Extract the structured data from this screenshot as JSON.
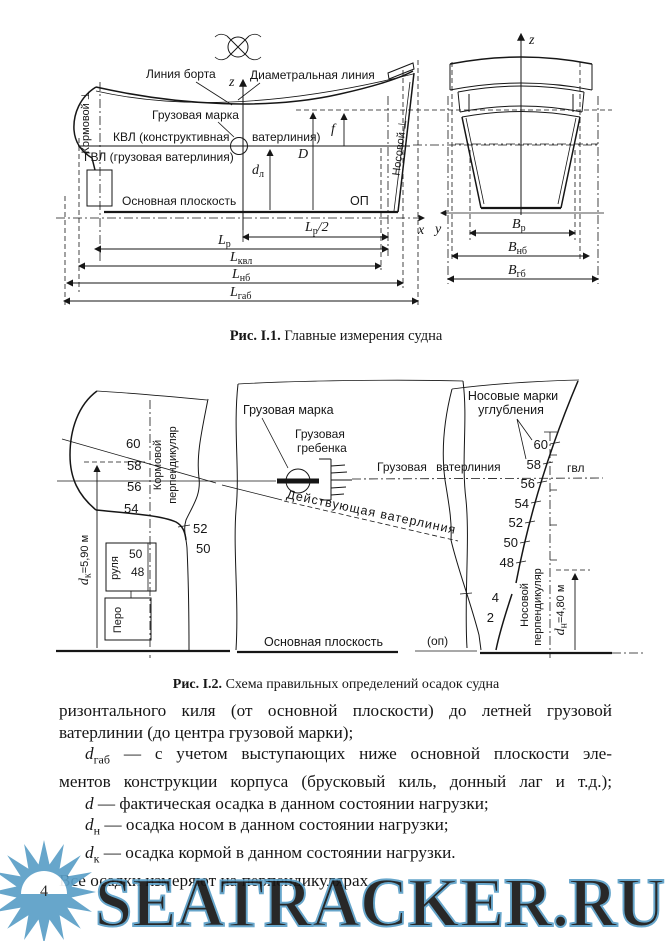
{
  "page": {
    "number": "4",
    "ink": "#161616",
    "paper": "#ffffff"
  },
  "fig1": {
    "caption": {
      "label": "Рис. I.1.",
      "text": "Главные измерения судна"
    },
    "labels": {
      "liniya_borta": "Линия борта",
      "diametralnaya": "Диаметральная линия",
      "gruzovaya_marka": "Грузовая марка",
      "kvl_left": "КВЛ (конструктивная",
      "kvl_right": "ватерлиния)",
      "gvl": "ГВЛ (грузовая ватерлиния)",
      "osnovnaya_ploskost": "Основная плоскость",
      "op": "ОП",
      "kormovoy_perp": "Кормовой ⊥",
      "nosovoy_perp": "Носовой ⊥"
    },
    "axes": {
      "z": "z",
      "x": "x",
      "y": "y"
    },
    "symbols": {
      "f": "f",
      "D": "D",
      "d": {
        "main": "d",
        "sub": "л"
      }
    },
    "dims": {
      "lp2": {
        "main": "L",
        "sub": "р",
        "suffix": "/2"
      },
      "lp": {
        "main": "L",
        "sub": "р"
      },
      "lkvl": {
        "main": "L",
        "sub": "квл"
      },
      "lnb": {
        "main": "L",
        "sub": "нб"
      },
      "lgab": {
        "main": "L",
        "sub": "габ"
      },
      "bp": {
        "main": "B",
        "sub": "р"
      },
      "bnb": {
        "main": "B",
        "sub": "нб"
      },
      "bgb": {
        "main": "B",
        "sub": "гб"
      }
    }
  },
  "fig2": {
    "caption": {
      "label": "Рис. I.2.",
      "text": "Схема правильных определений осадок судна"
    },
    "labels": {
      "gruzovaya_marka": "Грузовая марка",
      "grebenka1": "Грузовая",
      "grebenka2": "гребенка",
      "gruzovaya_vaterliniya": "Грузовая ватерлиния",
      "deystvuyushchaya": "Действующая ватерлиния",
      "nos_marki1": "Носовые марки",
      "nos_marki2": "углубления",
      "kormovoy1": "Кормовой",
      "kormovoy2": "перпендикуляр",
      "nosovoy1": "Носовой",
      "nosovoy2": "перпендикуляр",
      "pero": "Перо",
      "rulya": "руля",
      "osnovnaya_ploskost": "Основная плоскость",
      "op_small": "(оп)",
      "gvl_small": "гвл",
      "dk": {
        "main": "d",
        "sub": "к",
        "suffix": "=5,90 м"
      },
      "dn": {
        "main": "d",
        "sub": "н",
        "suffix": "=4,80 м"
      }
    },
    "stern_marks": [
      "60",
      "58",
      "56",
      "54"
    ],
    "skeg_marks": [
      "52",
      "50"
    ],
    "rudder_marks": [
      "50",
      "48"
    ],
    "bow_marks": [
      "60",
      "58",
      "56",
      "54",
      "52",
      "50",
      "48",
      "4",
      "2"
    ]
  },
  "body": {
    "line1": "ризонтального киля (от основной плоскости) до летней грузовой",
    "line2": "ватерлинии (до центра грузовой марки);",
    "p_gab": {
      "main": "d",
      "sub": "габ",
      "text1": " — с учетом выступающих ниже основной плоскости эле-",
      "text2": "ментов конструкции корпуса (брусковый киль, донный лаг и т.д.);"
    },
    "p_d": {
      "main": "d",
      "text": " — фактическая осадка в данном состоянии нагрузки;"
    },
    "p_dn": {
      "main": "d",
      "sub": "н",
      "text": " — осадка носом в данном состоянии нагрузки;"
    },
    "p_dk": {
      "main": "d",
      "sub": "к",
      "text": " — осадка кормой в данном состоянии нагрузки."
    },
    "last": "Все осадки измеряют на перпендикулярах."
  },
  "watermark": {
    "text": "SEATRACKER.RU",
    "color": "#5B9FC7"
  }
}
